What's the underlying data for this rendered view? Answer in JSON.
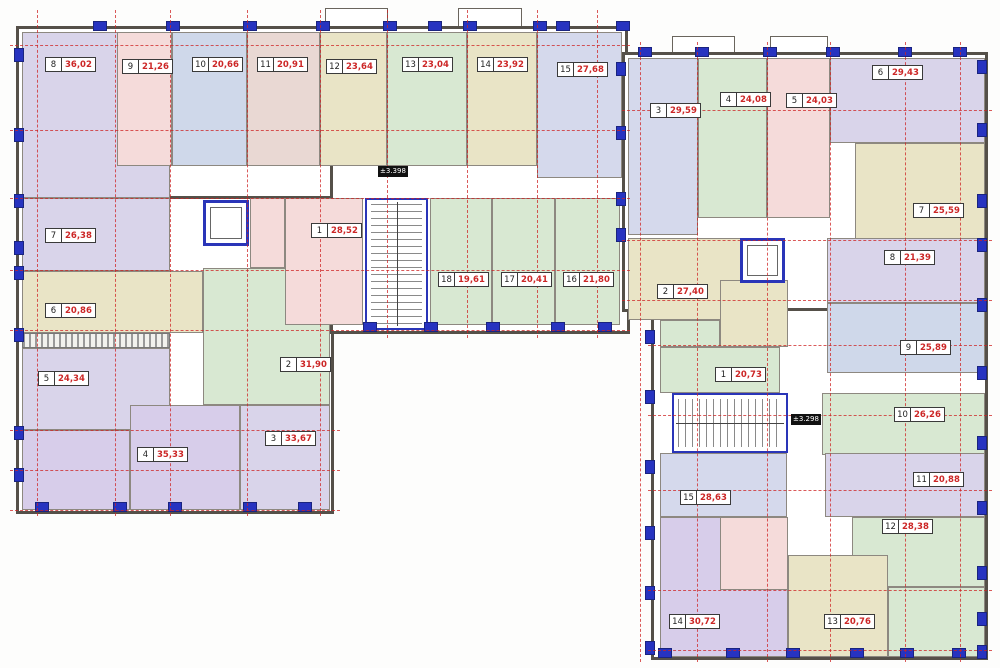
{
  "meta": {
    "type": "floor-plan",
    "description": "Residential multi-unit floor plan, two sections"
  },
  "palette": {
    "lavender": "#d9d4ea",
    "pink": "#f5dbda",
    "blue": "#cfd8ea",
    "rose": "#e9d8d3",
    "khaki": "#e9e4c6",
    "green": "#d8e8d2",
    "purple": "#d7cdea",
    "bluelav": "#d5d9ec"
  },
  "elevation_markers": [
    {
      "label": "±3.398",
      "x": 378,
      "y": 166
    },
    {
      "label": "±3.298",
      "x": 791,
      "y": 414
    }
  ],
  "sections": [
    {
      "id": "a",
      "name": "left-wing",
      "units": [
        {
          "number": "8",
          "area": "36,02",
          "color": "lavender",
          "rect": [
            22,
            32,
            148,
            166
          ],
          "label": [
            45,
            57
          ]
        },
        {
          "number": "9",
          "area": "21,26",
          "color": "pink",
          "rect": [
            117,
            32,
            55,
            134
          ],
          "label": [
            122,
            59
          ]
        },
        {
          "number": "10",
          "area": "20,66",
          "color": "blue",
          "rect": [
            172,
            32,
            75,
            134
          ],
          "label": [
            192,
            57
          ]
        },
        {
          "number": "11",
          "area": "20,91",
          "color": "rose",
          "rect": [
            247,
            32,
            73,
            134
          ],
          "label": [
            257,
            57
          ]
        },
        {
          "number": "12",
          "area": "23,64",
          "color": "khaki",
          "rect": [
            320,
            32,
            67,
            134
          ],
          "label": [
            326,
            59
          ]
        },
        {
          "number": "13",
          "area": "23,04",
          "color": "green",
          "rect": [
            387,
            32,
            80,
            134
          ],
          "label": [
            402,
            57
          ]
        },
        {
          "number": "14",
          "area": "23,92",
          "color": "khaki",
          "rect": [
            467,
            32,
            70,
            134
          ],
          "label": [
            477,
            57
          ]
        },
        {
          "number": "15",
          "area": "27,68",
          "color": "bluelav",
          "rect": [
            537,
            32,
            85,
            146
          ],
          "label": [
            557,
            62
          ]
        },
        {
          "number": "7",
          "area": "26,38",
          "color": "lavender",
          "rect": [
            22,
            198,
            148,
            73
          ],
          "label": [
            45,
            228
          ]
        },
        {
          "number": "6",
          "area": "20,86",
          "color": "khaki",
          "rect": [
            22,
            271,
            181,
            62
          ],
          "label": [
            45,
            303
          ]
        },
        {
          "number": "5",
          "area": "24,34",
          "color": "lavender",
          "rect": [
            22,
            348,
            148,
            82
          ],
          "label": [
            38,
            371
          ]
        },
        {
          "number": "4",
          "area": "35,33",
          "color": "purple",
          "rect": [
            130,
            405,
            110,
            105
          ],
          "label": [
            137,
            447
          ]
        },
        {
          "number": "3",
          "area": "33,67",
          "color": "lavender",
          "rect": [
            240,
            405,
            90,
            105
          ],
          "label": [
            265,
            431
          ]
        },
        {
          "number": "2",
          "area": "31,90",
          "color": "green",
          "rect": [
            203,
            268,
            127,
            137
          ],
          "label": [
            280,
            357
          ]
        },
        {
          "number": "1",
          "area": "28,52",
          "color": "pink",
          "rect": [
            285,
            198,
            78,
            127
          ],
          "label": [
            311,
            223
          ]
        },
        {
          "number": "18",
          "area": "19,61",
          "color": "green",
          "rect": [
            430,
            198,
            62,
            127
          ],
          "label": [
            438,
            272
          ]
        },
        {
          "number": "17",
          "area": "20,41",
          "color": "green",
          "rect": [
            492,
            198,
            63,
            127
          ],
          "label": [
            501,
            272
          ]
        },
        {
          "number": "16",
          "area": "21,80",
          "color": "green",
          "rect": [
            555,
            198,
            65,
            127
          ],
          "label": [
            563,
            272
          ]
        }
      ]
    },
    {
      "id": "b",
      "name": "right-wing",
      "units": [
        {
          "number": "3",
          "area": "29,59",
          "color": "bluelav",
          "rect": [
            628,
            58,
            70,
            177
          ],
          "label": [
            650,
            103
          ]
        },
        {
          "number": "4",
          "area": "24,08",
          "color": "green",
          "rect": [
            698,
            58,
            69,
            160
          ],
          "label": [
            720,
            92
          ]
        },
        {
          "number": "5",
          "area": "24,03",
          "color": "pink",
          "rect": [
            767,
            58,
            63,
            160
          ],
          "label": [
            786,
            93
          ]
        },
        {
          "number": "6",
          "area": "29,43",
          "color": "lavender",
          "rect": [
            830,
            58,
            155,
            85
          ],
          "label": [
            872,
            65
          ]
        },
        {
          "number": "7",
          "area": "25,59",
          "color": "khaki",
          "rect": [
            855,
            143,
            130,
            117
          ],
          "label": [
            913,
            203
          ]
        },
        {
          "number": "2",
          "area": "27,40",
          "color": "khaki",
          "rect": [
            628,
            238,
            145,
            82
          ],
          "label": [
            657,
            284
          ]
        },
        {
          "number": "8",
          "area": "21,39",
          "color": "lavender",
          "rect": [
            827,
            238,
            158,
            65
          ],
          "label": [
            884,
            250
          ]
        },
        {
          "number": "9",
          "area": "25,89",
          "color": "blue",
          "rect": [
            827,
            303,
            158,
            70
          ],
          "label": [
            900,
            340
          ]
        },
        {
          "number": "1",
          "area": "20,73",
          "color": "green",
          "rect": [
            660,
            347,
            120,
            46
          ],
          "label": [
            715,
            367
          ]
        },
        {
          "number": "10",
          "area": "26,26",
          "color": "green",
          "rect": [
            822,
            393,
            163,
            62
          ],
          "label": [
            894,
            407
          ]
        },
        {
          "number": "15",
          "area": "28,63",
          "color": "bluelav",
          "rect": [
            660,
            453,
            127,
            64
          ],
          "label": [
            680,
            490
          ]
        },
        {
          "number": "11",
          "area": "20,88",
          "color": "lavender",
          "rect": [
            825,
            453,
            160,
            64
          ],
          "label": [
            913,
            472
          ]
        },
        {
          "number": "12",
          "area": "28,38",
          "color": "green",
          "rect": [
            852,
            517,
            133,
            70
          ],
          "label": [
            882,
            519
          ]
        },
        {
          "number": "14",
          "area": "30,72",
          "color": "purple",
          "rect": [
            660,
            517,
            128,
            140
          ],
          "label": [
            669,
            614
          ]
        },
        {
          "number": "13",
          "area": "20,76",
          "color": "khaki",
          "rect": [
            788,
            555,
            100,
            102
          ],
          "label": [
            824,
            614
          ]
        }
      ]
    }
  ],
  "extra_rooms": [
    {
      "name": "unit-a4-room",
      "color": "purple",
      "rect": [
        22,
        430,
        108,
        80
      ]
    },
    {
      "name": "unit-a1-bath",
      "color": "pink",
      "rect": [
        250,
        198,
        35,
        70
      ]
    },
    {
      "name": "unit-b2-kitchen",
      "color": "khaki",
      "rect": [
        720,
        280,
        68,
        67
      ]
    },
    {
      "name": "unit-b1-entry",
      "color": "green",
      "rect": [
        660,
        320,
        60,
        27
      ]
    },
    {
      "name": "unit-b14-bath",
      "color": "pink",
      "rect": [
        720,
        517,
        68,
        73
      ]
    },
    {
      "name": "unit-b12-room",
      "color": "green",
      "rect": [
        888,
        587,
        97,
        70
      ]
    }
  ],
  "hatches": [
    {
      "name": "loggia-strip",
      "rect": [
        22,
        333,
        148,
        15
      ]
    }
  ],
  "shells": [
    {
      "rect": [
        16,
        26,
        612,
        176
      ]
    },
    {
      "rect": [
        16,
        196,
        318,
        318
      ]
    },
    {
      "rect": [
        330,
        162,
        300,
        172
      ]
    },
    {
      "rect": [
        622,
        52,
        366,
        260
      ]
    },
    {
      "rect": [
        651,
        308,
        337,
        352
      ]
    }
  ],
  "stairwells": [
    {
      "name": "stairwell-left",
      "rect": [
        365,
        198,
        63,
        132
      ],
      "dir": "v"
    },
    {
      "name": "stairwell-right",
      "rect": [
        672,
        393,
        116,
        60
      ],
      "dir": "h"
    }
  ],
  "elevators": [
    {
      "name": "elevator-left",
      "rect": [
        203,
        200,
        46,
        46
      ]
    },
    {
      "name": "elevator-right",
      "rect": [
        740,
        238,
        45,
        45
      ]
    }
  ],
  "balconies": [
    {
      "rect": [
        325,
        8,
        63,
        20
      ]
    },
    {
      "rect": [
        458,
        8,
        64,
        20
      ]
    },
    {
      "rect": [
        672,
        36,
        63,
        17
      ]
    },
    {
      "rect": [
        770,
        36,
        58,
        17
      ]
    }
  ],
  "windows": [
    {
      "x": 93,
      "y": 21,
      "o": "h"
    },
    {
      "x": 166,
      "y": 21,
      "o": "h"
    },
    {
      "x": 243,
      "y": 21,
      "o": "h"
    },
    {
      "x": 316,
      "y": 21,
      "o": "h"
    },
    {
      "x": 383,
      "y": 21,
      "o": "h"
    },
    {
      "x": 428,
      "y": 21,
      "o": "h"
    },
    {
      "x": 463,
      "y": 21,
      "o": "h"
    },
    {
      "x": 533,
      "y": 21,
      "o": "h"
    },
    {
      "x": 556,
      "y": 21,
      "o": "h"
    },
    {
      "x": 616,
      "y": 21,
      "o": "h"
    },
    {
      "x": 14,
      "y": 48,
      "o": "v"
    },
    {
      "x": 14,
      "y": 128,
      "o": "v"
    },
    {
      "x": 14,
      "y": 194,
      "o": "v"
    },
    {
      "x": 14,
      "y": 241,
      "o": "v"
    },
    {
      "x": 14,
      "y": 266,
      "o": "v"
    },
    {
      "x": 14,
      "y": 328,
      "o": "v"
    },
    {
      "x": 14,
      "y": 426,
      "o": "v"
    },
    {
      "x": 14,
      "y": 468,
      "o": "v"
    },
    {
      "x": 35,
      "y": 502,
      "o": "h"
    },
    {
      "x": 113,
      "y": 502,
      "o": "h"
    },
    {
      "x": 168,
      "y": 502,
      "o": "h"
    },
    {
      "x": 243,
      "y": 502,
      "o": "h"
    },
    {
      "x": 298,
      "y": 502,
      "o": "h"
    },
    {
      "x": 363,
      "y": 322,
      "o": "h"
    },
    {
      "x": 424,
      "y": 322,
      "o": "h"
    },
    {
      "x": 486,
      "y": 322,
      "o": "h"
    },
    {
      "x": 551,
      "y": 322,
      "o": "h"
    },
    {
      "x": 598,
      "y": 322,
      "o": "h"
    },
    {
      "x": 638,
      "y": 47,
      "o": "h"
    },
    {
      "x": 695,
      "y": 47,
      "o": "h"
    },
    {
      "x": 763,
      "y": 47,
      "o": "h"
    },
    {
      "x": 826,
      "y": 47,
      "o": "h"
    },
    {
      "x": 898,
      "y": 47,
      "o": "h"
    },
    {
      "x": 953,
      "y": 47,
      "o": "h"
    },
    {
      "x": 977,
      "y": 60,
      "o": "v"
    },
    {
      "x": 977,
      "y": 123,
      "o": "v"
    },
    {
      "x": 977,
      "y": 194,
      "o": "v"
    },
    {
      "x": 977,
      "y": 238,
      "o": "v"
    },
    {
      "x": 977,
      "y": 298,
      "o": "v"
    },
    {
      "x": 977,
      "y": 366,
      "o": "v"
    },
    {
      "x": 977,
      "y": 436,
      "o": "v"
    },
    {
      "x": 977,
      "y": 501,
      "o": "v"
    },
    {
      "x": 977,
      "y": 566,
      "o": "v"
    },
    {
      "x": 977,
      "y": 612,
      "o": "v"
    },
    {
      "x": 977,
      "y": 645,
      "o": "v"
    },
    {
      "x": 616,
      "y": 62,
      "o": "v"
    },
    {
      "x": 616,
      "y": 126,
      "o": "v"
    },
    {
      "x": 616,
      "y": 192,
      "o": "v"
    },
    {
      "x": 616,
      "y": 228,
      "o": "v"
    },
    {
      "x": 645,
      "y": 330,
      "o": "v"
    },
    {
      "x": 645,
      "y": 390,
      "o": "v"
    },
    {
      "x": 645,
      "y": 460,
      "o": "v"
    },
    {
      "x": 645,
      "y": 526,
      "o": "v"
    },
    {
      "x": 645,
      "y": 586,
      "o": "v"
    },
    {
      "x": 645,
      "y": 641,
      "o": "v"
    },
    {
      "x": 658,
      "y": 648,
      "o": "h"
    },
    {
      "x": 726,
      "y": 648,
      "o": "h"
    },
    {
      "x": 786,
      "y": 648,
      "o": "h"
    },
    {
      "x": 850,
      "y": 648,
      "o": "h"
    },
    {
      "x": 900,
      "y": 648,
      "o": "h"
    },
    {
      "x": 952,
      "y": 648,
      "o": "h"
    }
  ],
  "axes": {
    "vertical": [
      {
        "x": 37,
        "y1": 10,
        "y2": 516
      },
      {
        "x": 115,
        "y1": 10,
        "y2": 516
      },
      {
        "x": 170,
        "y1": 10,
        "y2": 516
      },
      {
        "x": 247,
        "y1": 10,
        "y2": 516
      },
      {
        "x": 320,
        "y1": 10,
        "y2": 516
      },
      {
        "x": 387,
        "y1": 10,
        "y2": 338
      },
      {
        "x": 467,
        "y1": 10,
        "y2": 338
      },
      {
        "x": 537,
        "y1": 10,
        "y2": 338
      },
      {
        "x": 597,
        "y1": 10,
        "y2": 338
      },
      {
        "x": 640,
        "y1": 42,
        "y2": 662
      },
      {
        "x": 697,
        "y1": 42,
        "y2": 662
      },
      {
        "x": 767,
        "y1": 42,
        "y2": 662
      },
      {
        "x": 830,
        "y1": 42,
        "y2": 662
      },
      {
        "x": 905,
        "y1": 42,
        "y2": 662
      },
      {
        "x": 960,
        "y1": 42,
        "y2": 662
      }
    ],
    "horizontal": [
      {
        "y": 45,
        "x1": 10,
        "x2": 630
      },
      {
        "y": 130,
        "x1": 10,
        "x2": 630
      },
      {
        "y": 198,
        "x1": 10,
        "x2": 630
      },
      {
        "y": 270,
        "x1": 10,
        "x2": 630
      },
      {
        "y": 330,
        "x1": 10,
        "x2": 630
      },
      {
        "y": 430,
        "x1": 10,
        "x2": 340
      },
      {
        "y": 470,
        "x1": 10,
        "x2": 340
      },
      {
        "y": 510,
        "x1": 10,
        "x2": 340
      },
      {
        "y": 110,
        "x1": 622,
        "x2": 992
      },
      {
        "y": 240,
        "x1": 622,
        "x2": 992
      },
      {
        "y": 300,
        "x1": 622,
        "x2": 992
      },
      {
        "y": 345,
        "x1": 648,
        "x2": 992
      },
      {
        "y": 415,
        "x1": 648,
        "x2": 992
      },
      {
        "y": 490,
        "x1": 648,
        "x2": 992
      },
      {
        "y": 590,
        "x1": 648,
        "x2": 992
      },
      {
        "y": 650,
        "x1": 648,
        "x2": 992
      }
    ]
  }
}
